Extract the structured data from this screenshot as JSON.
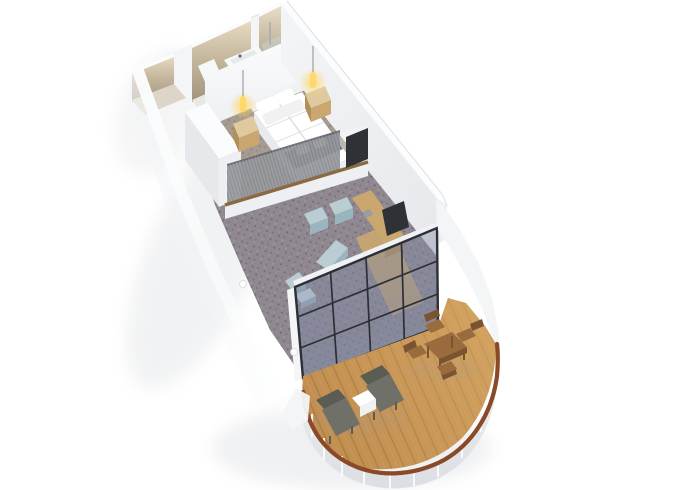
{
  "meta": {
    "background": "#ffffff"
  },
  "objects": [
    "entrance-hall",
    "bathroom",
    "bathtub",
    "vanity",
    "shower-room",
    "shower-glass",
    "bedroom",
    "wardrobe",
    "double-bed",
    "navy-bed-runner",
    "towels",
    "pillows",
    "nightstand-left",
    "nightstand-right",
    "pendant-lamp-left",
    "pendant-lamp-right",
    "room-divider",
    "divider-glass",
    "curtain",
    "bedroom-tv",
    "living-room",
    "armchair-1",
    "armchair-2",
    "chaise",
    "side-chair",
    "coffee-table",
    "desk",
    "desk-chair",
    "glass-wall",
    "balcony",
    "wood-deck",
    "lounger-1",
    "lounger-2",
    "deck-table",
    "dining-table",
    "dining-chairs",
    "railing",
    "handrail",
    "hull"
  ],
  "palette": {
    "bg": "#ffffff",
    "shadow": "#969da6",
    "wallWhite": "#f4f5f7",
    "wallWhiteMid": "#edeff2",
    "wallWhiteDark": "#e6e8eb",
    "wallWhiteDarker": "#dbdee2",
    "wallTop": "#fbfcfd",
    "wallEdge": "#dadde1",
    "beigeTop": "#e9dcc3",
    "beige": "#c7b9a0",
    "beigeDark": "#a2947c",
    "bathFloor": "#eae8e2",
    "corridorFloor": "#ddd6c8",
    "vanityWhite": "#f7f8fa",
    "carpetBed": "#a59b90",
    "carpetBedDot": "#8b8074",
    "carpetBedLight": "#b6ada2",
    "carpetLiv": "#8f8890",
    "carpetLivDot": "#6f6871",
    "carpetLivLight": "#a29ba3",
    "woodLight": "#dfca9f",
    "wood": "#c9a76f",
    "woodFront": "#b28e58",
    "woodDark": "#8b6a42",
    "navy": "#3a4860",
    "navyDark": "#2d3950",
    "white": "#ffffff",
    "offWhite": "#f0f1f3",
    "duvetShadow": "#dcdde2",
    "bedBase": "#e9eaee",
    "lampGlow": "#ffd76a",
    "lampCord": "#8d8d8d",
    "curtain": "#6e7178",
    "curtainDark": "#54575e",
    "tvDark": "#2e3136",
    "blueChair": "#b9cdd3",
    "blueChairDark": "#9bb5be",
    "blueTable": "#cddde2",
    "glassFill": "#7e88a4",
    "glassFrame": "#2c2f35",
    "glassBeam": "#eff1f4",
    "deck": "#c28f51",
    "deckMid": "#cf9f5e",
    "deckLine": "#ab7c41",
    "deckLight": "#ddb06c",
    "rail": "#8a4a28",
    "lounger": "#6f7168",
    "loungerDark": "#5b5d55",
    "diningWood": "#9a6b3c",
    "diningDark": "#7a5430",
    "skirt": "#f2f4f6",
    "post": "#fafbfc",
    "sconce": "#fdfdfd",
    "chrome": "#a6acb2"
  }
}
